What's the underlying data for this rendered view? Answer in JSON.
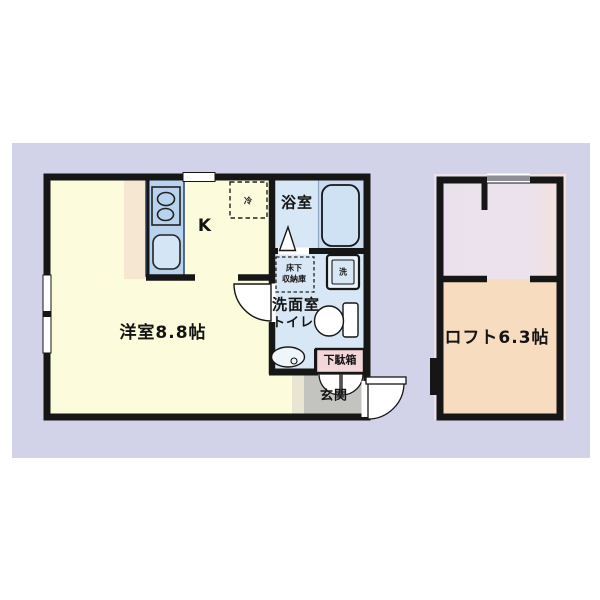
{
  "floorplan": {
    "labels": {
      "kitchen": "K",
      "refrigerator": "冷",
      "bathroom": "浴室",
      "underfloor_storage_line1": "床下",
      "underfloor_storage_line2": "収納庫",
      "washing_machine": "洗",
      "washroom": "洗面室",
      "toilet": "トイレ",
      "shoe_cabinet": "下駄箱",
      "entrance": "玄関",
      "main_room": "洋室8.8帖",
      "loft": "ロフト6.3帖"
    },
    "colors": {
      "page_background": "#ffffff",
      "panel_background": "#d2d2e8",
      "wall": "#161616",
      "main_room_fill": "#fcfbdc",
      "kitchen_strip_fill": "#f6e7d2",
      "kitchen_counter_fill": "#b9d3ee",
      "wet_area_fill": "#d8e7f5",
      "bathtub_area_fill": "#c9dcf0",
      "shoe_cabinet_fill": "#f2d6da",
      "entrance_fill": "#c3c3bf",
      "loft_upper_fill": "#ebe1ed",
      "loft_room_fill": "#f8dcc0",
      "window_gray": "#8e8e96"
    }
  }
}
